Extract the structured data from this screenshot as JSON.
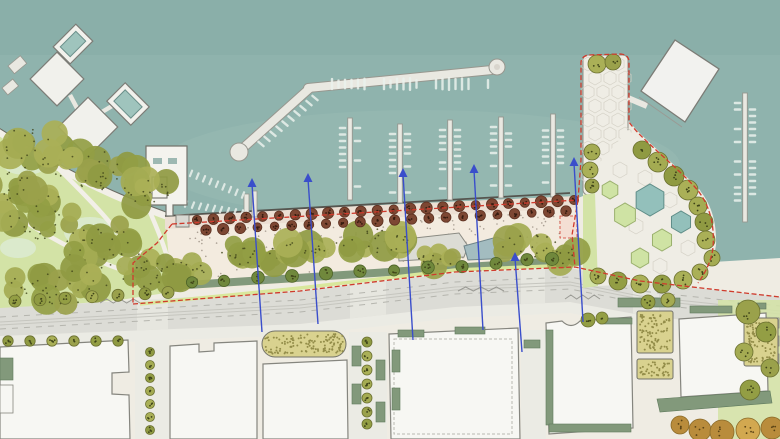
{
  "meta": {
    "title": "Waterfront marina masterplan site plan",
    "width": 780,
    "height": 439
  },
  "palette": {
    "water": "#8fb3ad",
    "waterDeep": "#86aba6",
    "waterLight": "#9dbfb8",
    "land": "#efece3",
    "lawn": "#d3e3a6",
    "lawnLight": "#dcead0",
    "canopy": [
      "#9aa14b",
      "#8f9a42",
      "#a4ab52",
      "#939e44",
      "#aab057"
    ],
    "orange": [
      "#c89a44",
      "#b98c3c",
      "#d2a850"
    ],
    "canopyDot": "#3f4419",
    "treeStroke": "#6b7030",
    "brownTree": "#7d4733",
    "brownTreeStroke": "#5d3121",
    "brownTreeDot": "#371c10",
    "deck": "#f3ebdf",
    "deckBand": "#ecdfd3",
    "deckDot": "#8a7f72",
    "sage": "#82997b",
    "shrub": "#70883c",
    "road": "#dcdcd6",
    "roadLine": "#b5b5ae",
    "sidewalk": "#ebebe4",
    "crosswalk": "#e6e6df",
    "building": "#f7f7f3",
    "buildingStroke": "#85857e",
    "buildingDetail": "#b9b9b2",
    "garden": "#d9d28f",
    "gardenDot": "#938d49",
    "gardenStroke": "#73736a",
    "dock": "#e9e8e1",
    "dockStroke": "#97978f",
    "boat": "#eaf1ec",
    "pool": "#9fc4bd",
    "pond": "#a3bcc0",
    "pondStroke": "#6f8489",
    "hexTeal": "#93c0bb",
    "hexTealStroke": "#5f8d88",
    "hexGreen": "#cfe3a4",
    "hexGreenStroke": "#9ab06d",
    "paver": "#efede5",
    "paverLine": "#d4d1c6",
    "red": "#cf3b2d",
    "blue": "#3a4ecb",
    "bike": "#d9e79c",
    "track": "#c6c6bf",
    "pink": "#f4ded3",
    "pathLight": "#f2efe8",
    "seawall": "#55554f",
    "shoreline": "#6a6a62"
  },
  "geometry": {
    "land": "M0,128 C40,158 90,185 140,205 C155,211 165,216 172,222 L578,198 L583,196 L583,64 Q583,56 592,55 L620,54 Q628,55 628,63 L628,120 C642,138 668,158 695,185 C710,200 717,220 716,245 L713,262 L780,258 L780,439 L0,439 Z",
    "shorelinePath": "M-4,130 C48,164 102,192 150,210 L166,216",
    "park": {
      "lawn": "M0,128 C40,158 90,185 140,205 L165,215 L172,292 L120,300 L0,310 Z",
      "patches": [
        [
          25,
          162,
          24,
          13
        ],
        [
          90,
          232,
          26,
          15
        ],
        [
          18,
          248,
          18,
          10
        ]
      ],
      "paths": [
        "M150,212 C160,235 168,255 172,278",
        "M60,170 C90,200 118,228 134,256 C140,266 150,271 160,267",
        "M2,206 C42,234 82,256 122,270"
      ],
      "plazaBlob": [
        133,
        260,
        14,
        10
      ],
      "clusters": [
        [
          30,
          150,
          38,
          22,
          10
        ],
        [
          95,
          170,
          45,
          20,
          12
        ],
        [
          148,
          192,
          28,
          14,
          8
        ],
        [
          35,
          215,
          40,
          26,
          12
        ],
        [
          105,
          245,
          42,
          24,
          12
        ],
        [
          55,
          285,
          55,
          20,
          14
        ],
        [
          150,
          272,
          30,
          16,
          8
        ],
        [
          10,
          185,
          25,
          15,
          7
        ]
      ]
    },
    "promenade": {
      "deck": "M165,215 L578,196 L578,263 L172,292 Z",
      "band": "M165,215 L578,196 L578,208 L165,229 Z",
      "sageStrip": "M172,282 L575,256 L575,264 L172,290 Z",
      "kiosk": [
        176,
        215,
        13,
        12
      ],
      "pavilion": "M397,240 L459,233 L468,246 L464,257 L399,261 Z",
      "pond": "M464,246 L497,237 L514,244 L511,258 L468,260 Z",
      "dots": 170,
      "northEdge": [
        [
          170,
          222
        ],
        [
          575,
          199
        ]
      ],
      "southEdge": [
        [
          172,
          288
        ],
        [
          575,
          260
        ]
      ],
      "treeRows": [
        {
          "from": [
            197,
            220
          ],
          "to": [
            574,
            200
          ],
          "n": 24,
          "r": 5.2
        },
        {
          "from": [
            206,
            230
          ],
          "to": [
            566,
            211
          ],
          "n": 22,
          "r": 5.0
        }
      ],
      "shrubClusters": [
        [
          248,
          256,
          34,
          13,
          9
        ],
        [
          305,
          247,
          22,
          10,
          6
        ],
        [
          372,
          242,
          38,
          13,
          10
        ],
        [
          438,
          258,
          20,
          9,
          5
        ],
        [
          528,
          246,
          32,
          12,
          8
        ],
        [
          565,
          256,
          14,
          8,
          4
        ],
        [
          185,
          272,
          20,
          11,
          6
        ]
      ],
      "stripShrubXs": [
        192,
        224,
        258,
        292,
        326,
        360,
        394,
        428,
        462,
        496,
        527,
        552
      ],
      "pinkPad": [
        560,
        216,
        17,
        22
      ]
    },
    "roadway": {
      "top": [
        [
          0,
          308
        ],
        [
          300,
          291
        ],
        [
          455,
          273
        ],
        [
          570,
          268
        ],
        [
          640,
          282
        ],
        [
          780,
          297
        ]
      ],
      "bottom": [
        [
          0,
          336
        ],
        [
          300,
          324
        ],
        [
          455,
          307
        ],
        [
          570,
          302
        ],
        [
          640,
          315
        ],
        [
          780,
          331
        ]
      ],
      "bike": [
        [
          140,
          304
        ],
        [
          300,
          288
        ],
        [
          455,
          270
        ],
        [
          575,
          265
        ]
      ],
      "crosswalkX": [
        [
          137,
          168
        ],
        [
          350,
          386
        ],
        [
          521,
          545
        ],
        [
          633,
          659
        ]
      ],
      "zigzags": [
        [
          100,
          303,
          140,
          303
        ],
        [
          458,
          291,
          504,
          289
        ],
        [
          565,
          299,
          600,
          301
        ]
      ]
    },
    "blocks": {
      "buildings": [
        "M0,347 L128,340 L129,372 L112,373 L112,394 L129,395 L130,439 L0,439 Z",
        "M170,346 L199,344 L199,352 L214,351 L214,343 L257,341 L257,439 L170,439 Z",
        "M263,364 L347,360 L348,439 L263,439 Z",
        "M389,334 L518,328 L520,439 L391,439 Z",
        "M546,323 L562,321 Q571,330 580,321 L631,317 L633,428 L549,434 Z",
        "M679,319 L766,313 L768,391 L681,397 Z"
      ],
      "dashedRoof": [
        394,
        339,
        118,
        95
      ],
      "gardens": [
        [
          262,
          331,
          84,
          26,
          13
        ],
        [
          637,
          311,
          36,
          42,
          2
        ],
        [
          637,
          359,
          36,
          20,
          2
        ],
        [
          744,
          318,
          34,
          48,
          2
        ]
      ],
      "sageRects": [
        [
          392,
          350,
          8,
          22
        ],
        [
          392,
          388,
          8,
          22
        ],
        [
          398,
          330,
          26,
          7
        ],
        [
          455,
          327,
          30,
          7
        ],
        [
          546,
          330,
          7,
          95
        ],
        [
          600,
          318,
          32,
          6
        ],
        [
          549,
          424,
          82,
          8
        ],
        [
          618,
          298,
          62,
          9
        ],
        [
          690,
          306,
          42,
          7
        ],
        [
          738,
          303,
          28,
          6
        ],
        [
          352,
          346,
          9,
          20
        ],
        [
          352,
          384,
          9,
          20
        ],
        [
          376,
          360,
          9,
          20
        ],
        [
          376,
          402,
          9,
          20
        ],
        [
          0,
          358,
          13,
          22
        ],
        [
          524,
          340,
          16,
          8
        ]
      ],
      "sageWedge": "M657,399 L770,391 L772,403 L660,412 Z",
      "whitePlanters": [
        [
          770,
          318,
          9,
          10
        ],
        [
          770,
          336,
          9,
          10
        ],
        [
          770,
          354,
          9,
          10
        ],
        [
          0,
          385,
          13,
          28
        ]
      ],
      "streets": [
        [
          135,
          340,
          34,
          99
        ],
        [
          349,
          332,
          38,
          107
        ],
        [
          521,
          330,
          25,
          109
        ]
      ],
      "rightLawn": [
        718,
        300,
        62,
        139
      ]
    },
    "plaza": {
      "pier": [
        583,
        55,
        45,
        140
      ],
      "deck": "M595,168 L628,130 L652,150 L700,190 L714,224 L712,258 L694,282 L640,284 L598,286 L592,250 Z",
      "lawnStrip": "M583,195 L595,193 L598,286 L583,288 Z",
      "tealHexes": [
        [
          650,
          200,
          16
        ],
        [
          681,
          222,
          11
        ]
      ],
      "greenHexes": [
        [
          625,
          215,
          12
        ],
        [
          662,
          240,
          11
        ],
        [
          640,
          258,
          10
        ],
        [
          610,
          190,
          9
        ]
      ],
      "pierHexGrid": [
        588,
        64,
        3,
        9,
        15,
        14
      ],
      "deckHexes": [
        [
          620,
          170,
          8
        ],
        [
          645,
          178,
          8
        ],
        [
          670,
          200,
          8
        ],
        [
          636,
          226,
          8
        ],
        [
          688,
          248,
          8
        ],
        [
          660,
          266,
          8
        ]
      ]
    },
    "marina": {
      "bulb1": [
        239,
        152,
        9
      ],
      "bulb2": [
        497,
        67,
        8
      ],
      "arm1": [
        [
          243,
          148
        ],
        [
          310,
          88
        ]
      ],
      "arm2": [
        [
          308,
          88
        ],
        [
          492,
          70
        ]
      ],
      "fingerDocks": [
        [
          350,
          118,
          200
        ],
        [
          400,
          124,
          203
        ],
        [
          450,
          120,
          200
        ],
        [
          501,
          117,
          198
        ],
        [
          553,
          114,
          197
        ],
        [
          745,
          93,
          222
        ]
      ],
      "stubDocks": [
        [
          244,
          194,
          5,
          24
        ],
        [
          252,
          191,
          5,
          26
        ]
      ],
      "topRowBoats": {
        "y": 78,
        "x1": 332,
        "x2": 492,
        "step": 6.5
      },
      "diagBoats": {
        "from": [
          258,
          140
        ],
        "to": [
          312,
          94
        ],
        "n": 10
      },
      "shoreBoats": [
        {
          "from": [
            178,
            172
          ],
          "to": [
            243,
            199
          ],
          "n": 11
        },
        {
          "from": [
            186,
            208
          ],
          "to": [
            242,
            217
          ],
          "n": 9
        }
      ]
    },
    "platforms": {
      "diamonds": [
        {
          "cx": 73,
          "cy": 44,
          "w": 32,
          "h": 24,
          "rot": -45,
          "pool": true
        },
        {
          "cx": 57,
          "cy": 79,
          "w": 38,
          "h": 38,
          "rot": 45,
          "pool": false
        },
        {
          "cx": 88,
          "cy": 127,
          "w": 42,
          "h": 42,
          "rot": 45,
          "pool": false
        },
        {
          "cx": 128,
          "cy": 104,
          "w": 34,
          "h": 26,
          "rot": 45,
          "pool": true
        }
      ],
      "bridges": [
        [
          73,
          44,
          57,
          79
        ],
        [
          70,
          95,
          78,
          110
        ],
        [
          102,
          112,
          112,
          106
        ],
        [
          88,
          143,
          74,
          158
        ]
      ],
      "stubPiers": [
        [
          8,
          66,
          16,
          10,
          -40
        ],
        [
          2,
          88,
          14,
          9,
          -40
        ]
      ],
      "dockHouse": "M146,146 L187,146 L187,205 L173,205 L173,216 L166,216 L166,205 L146,205 Z",
      "dockHouseSlots": [
        [
          153,
          158,
          9,
          6
        ],
        [
          168,
          158,
          9,
          6
        ]
      ],
      "dockHouseInner": [
        152,
        177,
        15,
        21
      ],
      "neBuilding": "M641,91 L675,40 L719,69 L685,122 Z",
      "neBuildingShadow": [
        [
          639,
          97
        ],
        [
          682,
          127
        ]
      ],
      "neBridge": [
        [
          628,
          98
        ],
        [
          647,
          106
        ]
      ]
    },
    "trees": {
      "pierTop": [
        [
          597,
          64,
          9
        ],
        [
          613,
          62,
          8
        ]
      ],
      "plazaSingles": [
        [
          592,
          152,
          8
        ],
        [
          590,
          170,
          8
        ],
        [
          592,
          186,
          7
        ],
        [
          642,
          150,
          9
        ],
        [
          658,
          162,
          10
        ],
        [
          674,
          176,
          10
        ],
        [
          688,
          190,
          10
        ],
        [
          698,
          206,
          9
        ],
        [
          704,
          222,
          9
        ],
        [
          706,
          240,
          9
        ],
        [
          598,
          276,
          8
        ],
        [
          618,
          281,
          9
        ],
        [
          640,
          284,
          9
        ],
        [
          662,
          284,
          9
        ],
        [
          683,
          280,
          9
        ],
        [
          700,
          272,
          8
        ],
        [
          712,
          258,
          8
        ]
      ],
      "roadTopRow": [
        15,
        40,
        65,
        92,
        118,
        145,
        168
      ],
      "blockTopRow": [
        8,
        30,
        52,
        74,
        96,
        118
      ],
      "street1": {
        "x": 150,
        "ys": [
          352,
          365,
          378,
          391,
          404,
          417,
          430
        ],
        "r": 4.5
      },
      "street2": {
        "x": 367,
        "ys": [
          342,
          356,
          370,
          384,
          398,
          412,
          424
        ],
        "r": 5
      },
      "courtyard": [
        [
          648,
          302,
          7
        ],
        [
          668,
          300,
          7
        ],
        [
          588,
          320,
          7
        ],
        [
          602,
          318,
          6
        ]
      ],
      "rightGarden": [
        [
          748,
          312,
          12
        ],
        [
          766,
          332,
          10
        ],
        [
          744,
          352,
          9
        ],
        [
          770,
          368,
          9
        ],
        [
          750,
          390,
          10
        ]
      ],
      "orangeRow": [
        [
          680,
          425,
          9
        ],
        [
          700,
          430,
          11
        ],
        [
          722,
          432,
          12
        ],
        [
          748,
          430,
          12
        ],
        [
          772,
          428,
          11
        ]
      ]
    },
    "boundary": [
      "M172,224 L578,200",
      "M578,200 L581,160 L581,63 Q581,56 589,55 L621,54 Q629,55 629,62 L629,122 C641,139 667,158 694,186 C708,201 715,222 713,247 C712,259 706,272 698,283",
      "M133,304 L300,291 L455,272 L575,267 L640,281 L780,297",
      "M172,224 L157,243 L133,263 L133,304",
      "M578,200 L572,235 L575,267"
    ],
    "sections": [
      {
        "x": 252,
        "tipY": 178,
        "endX": 262,
        "endY": 332
      },
      {
        "x": 308,
        "tipY": 173,
        "endX": 318,
        "endY": 324
      },
      {
        "x": 403,
        "tipY": 168,
        "endX": 413,
        "endY": 340
      },
      {
        "x": 474,
        "tipY": 164,
        "endX": 483,
        "endY": 330
      },
      {
        "x": 515,
        "tipY": 252,
        "endX": 522,
        "endY": 352
      },
      {
        "x": 574,
        "tipY": 157,
        "endX": 583,
        "endY": 322
      }
    ]
  }
}
